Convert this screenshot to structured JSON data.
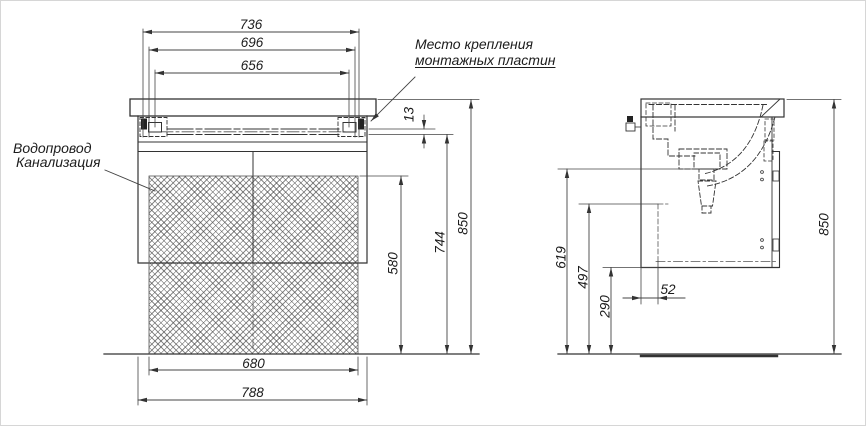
{
  "front": {
    "dims": {
      "d736": "736",
      "d696": "696",
      "d656": "656",
      "d13": "13",
      "d580": "580",
      "d744": "744",
      "d850": "850",
      "d680": "680",
      "d788": "788"
    },
    "labels": {
      "mount1": "Место крепления",
      "mount2": "монтажных пластин",
      "water": "Водопровод",
      "sewer": "Канализация"
    }
  },
  "side": {
    "dims": {
      "d619": "619",
      "d497": "497",
      "d290": "290",
      "d52": "52",
      "d850": "850"
    }
  }
}
